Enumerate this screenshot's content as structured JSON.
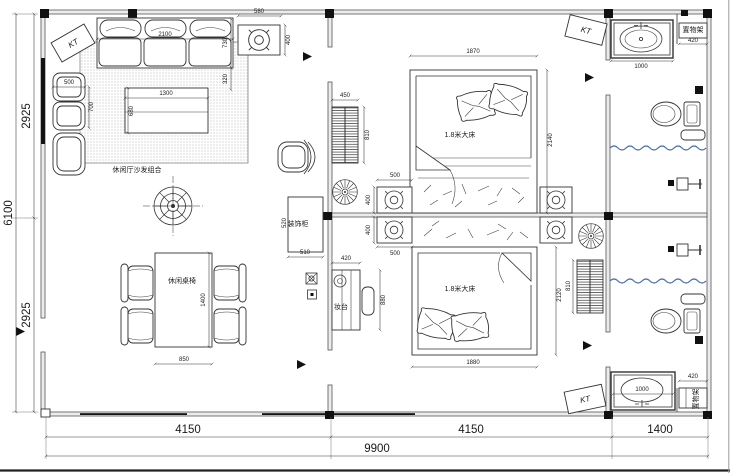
{
  "plan": {
    "colors": {
      "water_line": "#4a6db5"
    },
    "labels": {
      "kt": "KT",
      "sofa_area": "休闲厅沙发组合",
      "dining_set": "休闲桌椅",
      "bed1": "1.8米大床",
      "bed2": "1.8米大床",
      "deco_cabinet": "装饰柜",
      "dresser": "妆台",
      "shelf_top": "置物架",
      "shelf_bottom": "置物架"
    },
    "dims": {
      "total_width": "9900",
      "bay_living": "4150",
      "bay_bedrooms": "4150",
      "bay_bath": "1400",
      "total_height": "6100",
      "height_upper": "2925",
      "height_lower": "2925",
      "sofa_width": "2100",
      "sofa_depth": "730",
      "sofa_gap": "320",
      "side_table_width": "580",
      "side_table_depth": "400",
      "armchair_width": "500",
      "armchair_depth": "700",
      "coffee_table_width": "1300",
      "coffee_table_depth": "680",
      "dining_table_width": "850",
      "dining_table_length": "1400",
      "wardrobe1_width": "450",
      "wardrobe1_depth": "810",
      "bed1_width": "1870",
      "bed1_length": "2140",
      "nightstand_width_upper": "500",
      "nightstand_depth_upper": "400",
      "nightstand_depth_lower": "400",
      "nightstand_width_lower": "500",
      "cabinet_width": "510",
      "cabinet_depth": "520",
      "dresser_width": "420",
      "dresser_length": "880",
      "bed2_width": "1880",
      "bed2_length": "2120",
      "wardrobe2_depth": "810",
      "basin_top": "1000",
      "shelf_top": "420",
      "basin_bottom": "1000",
      "shelf_bottom": "420"
    }
  }
}
